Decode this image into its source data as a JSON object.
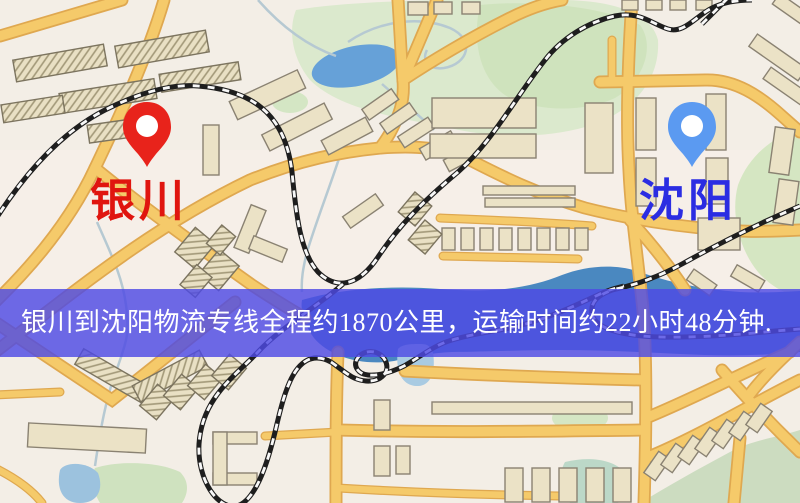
{
  "image": {
    "type": "street-map-with-route-banner",
    "width_px": 800,
    "height_px": 503
  },
  "markers": {
    "origin": {
      "label": "银川",
      "pin_color": "#e8231b",
      "label_color": "#e0150f"
    },
    "destination": {
      "label": "沈阳",
      "pin_color": "#5b9af1",
      "label_color": "#2b2de2"
    }
  },
  "banner": {
    "text": "银川到沈阳物流专线全程约1870公里，运输时间约22小时48分钟.",
    "background_color": "#4e4ae4",
    "text_color": "#ffffff"
  },
  "map_palette": {
    "background": "#f3eee6",
    "road_fill": "#f5ca6a",
    "road_casing": "#dfa850",
    "building_fill": "#ebe2c6",
    "building_outline": "#8a8272",
    "hatched_building_line": "#a29878",
    "park_green": "#d8e8ca",
    "lake_blue": "#66a1d8",
    "river_blue": "#4a88c0",
    "railway_black": "#1e1e1e"
  }
}
